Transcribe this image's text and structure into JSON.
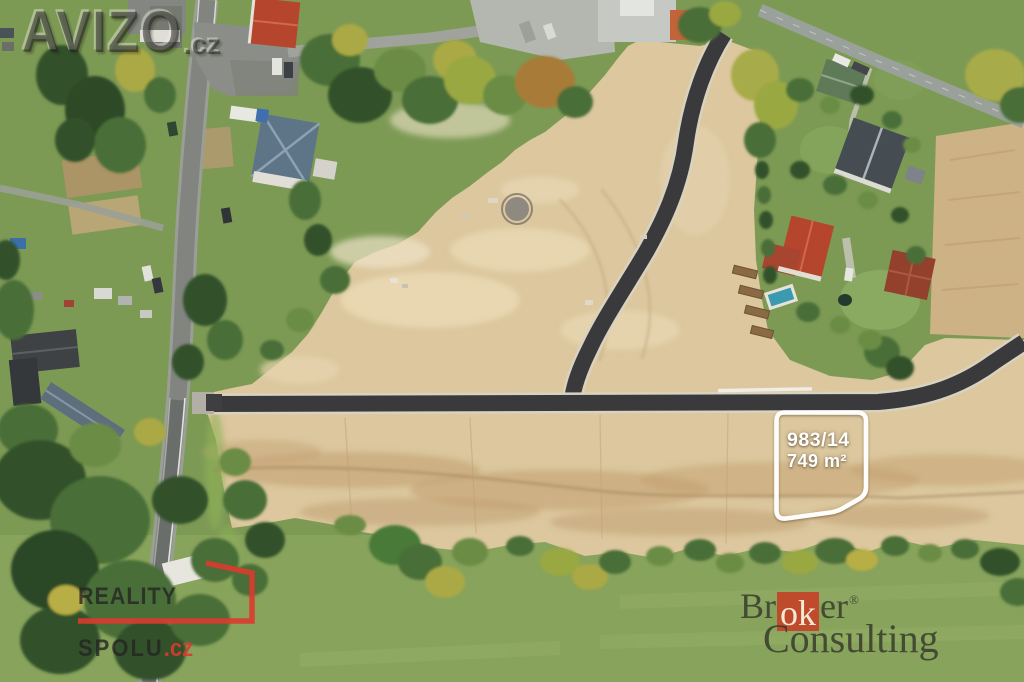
{
  "watermark": {
    "brand": "AVIZO",
    "tld": ".cz"
  },
  "plot_overlay": {
    "parcel_number": "983/14",
    "area": "749 m²",
    "outline_color": "#ffffff"
  },
  "logos": {
    "reality_spolu": {
      "line1": "REALITY",
      "line2": "SPOLU",
      "tld": ".cz",
      "accent_color": "#dc3a2e"
    },
    "broker_consulting": {
      "prefix": "Br",
      "highlight": "ok",
      "suffix": "er",
      "registered": "®",
      "line2": "Consulting",
      "box_color": "#bf4a2c"
    }
  },
  "palette": {
    "grass": "#7d9a55",
    "meadow": "#88a35c",
    "sand": "#dcc79e",
    "field": "#cdb285",
    "asphalt_new": "#3a3a3c",
    "road_old": "#82857f",
    "roof_red": "#b5452c",
    "roof_slate": "#454c52",
    "roof_blue": "#5e7587"
  }
}
